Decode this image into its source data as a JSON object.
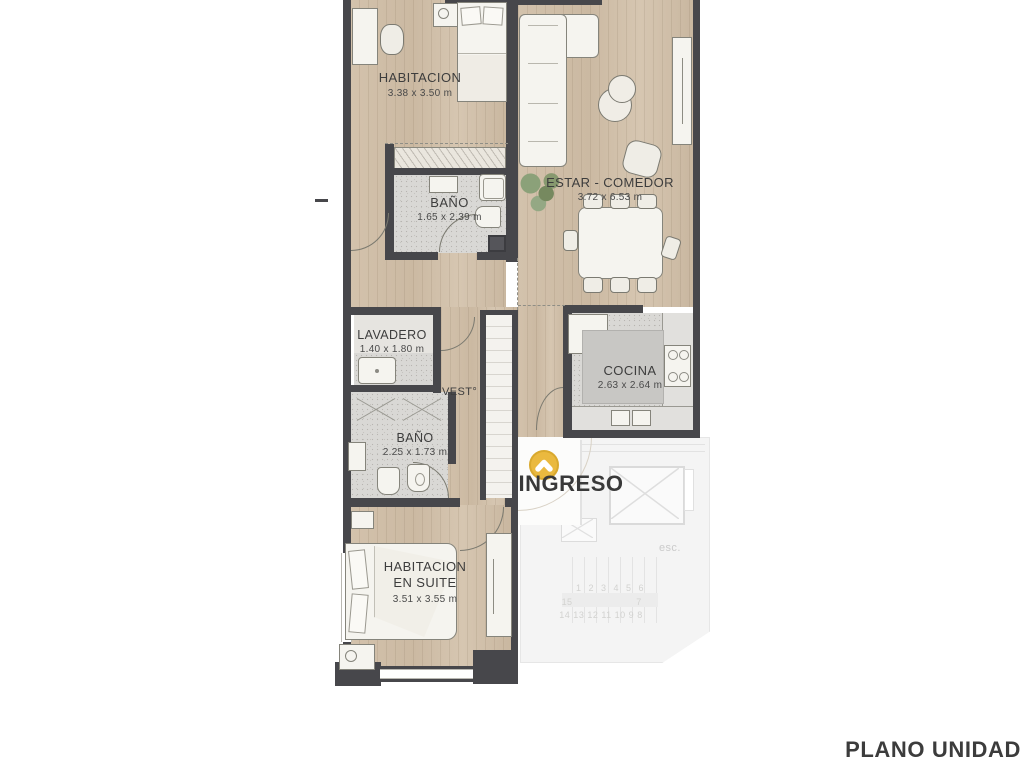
{
  "title": {
    "text": "PLANO UNIDAD"
  },
  "rooms": [
    {
      "id": "habitacion",
      "name": "HABITACION",
      "dims": "3.38 x 3.50 m"
    },
    {
      "id": "bano1",
      "name": "BAÑO",
      "dims": "1.65 x 2.39 m"
    },
    {
      "id": "estar_comedor",
      "name": "ESTAR - COMEDOR",
      "dims": "3.72 x 6.53 m"
    },
    {
      "id": "lavadero",
      "name": "LAVADERO",
      "dims": "1.40 x 1.80 m"
    },
    {
      "id": "vestibulo",
      "name": "VEST°"
    },
    {
      "id": "cocina",
      "name": "COCINA",
      "dims": "2.63 x 2.64 m"
    },
    {
      "id": "bano2",
      "name": "BAÑO",
      "dims": "2.25 x 1.73 m"
    },
    {
      "id": "suite",
      "name_line1": "HABITACION",
      "name_line2": "EN SUITE",
      "dims": "3.51 x 3.55 m"
    }
  ],
  "entrance": {
    "label": "INGRESO",
    "icon": "entrance-marker-icon",
    "icon_color": "#eab93f"
  },
  "common_area": {
    "stairs_label": "esc.",
    "stair_numbers_top": "1 2 3 4 5 6",
    "stair_left": "15",
    "stair_right": "7",
    "stair_numbers_bottom": "14 13 12 11 10 9 8"
  },
  "colors": {
    "wall": "#47474b",
    "wood": "#cfbda6",
    "tile": "#d9d8d5",
    "accent": "#eab93f",
    "label": "#3d3d3d",
    "common": "#f4f4f4"
  }
}
